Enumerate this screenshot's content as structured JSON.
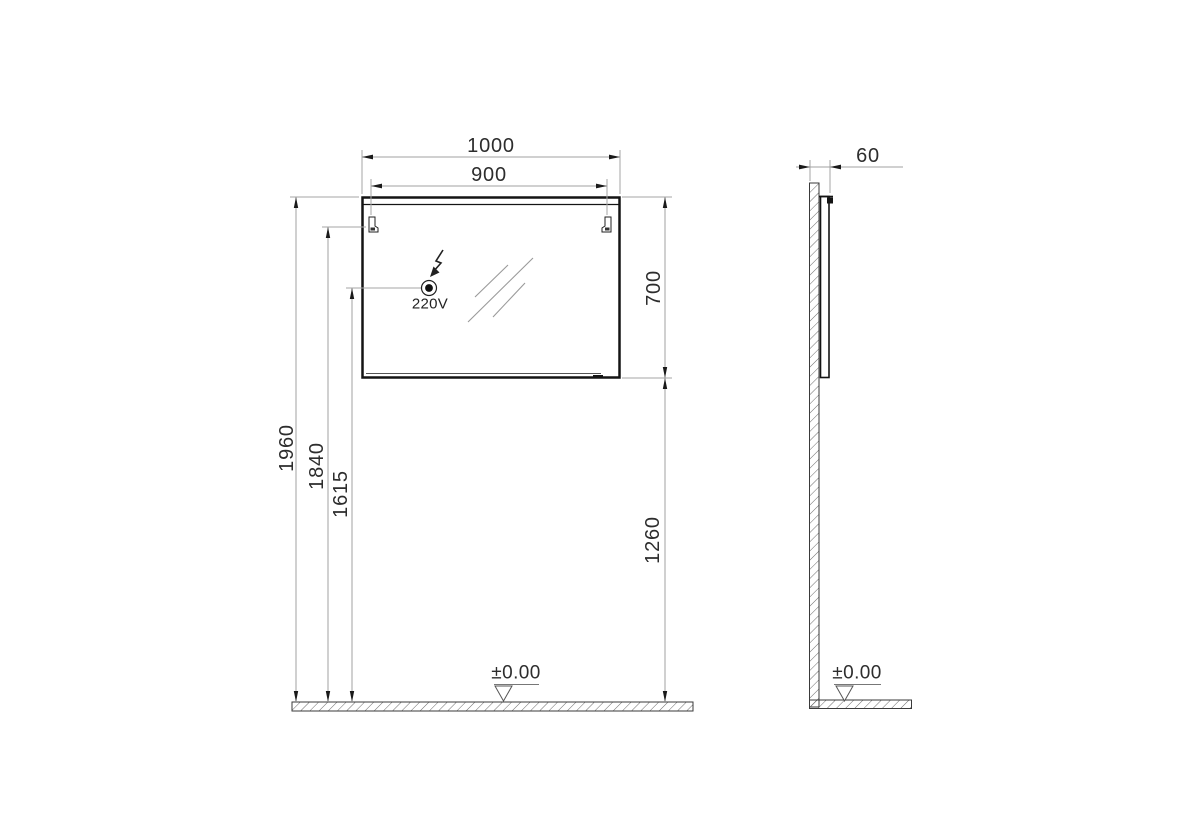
{
  "drawing_title": "Mirror with light - installation dimensions",
  "front_view": {
    "dim_width_total": "1000",
    "dim_width_mounting": "900",
    "dim_height_mirror": "700",
    "dim_height_total": "1960",
    "dim_height_mounting": "1840",
    "dim_height_socket": "1615",
    "dim_height_mirror_bottom": "1260",
    "socket_label": "220V",
    "floor_level_label": "±0.00"
  },
  "side_view": {
    "dim_depth": "60",
    "floor_level_label": "±0.00"
  },
  "icons": {
    "lightning": "electric-supply-arrow",
    "socket": "power-outlet-point",
    "datum_triangle": "floor-level-datum",
    "bracket": "wall-mounting-bracket",
    "glass": "mirror-reflection-strokes",
    "hatch": "wall-floor-section-hatch"
  },
  "colors": {
    "background": "#ffffff",
    "outline": "#141414",
    "dimension_line": "#a0a0a0",
    "text": "#2d2d2d",
    "hatch": "#5a5a5a"
  }
}
